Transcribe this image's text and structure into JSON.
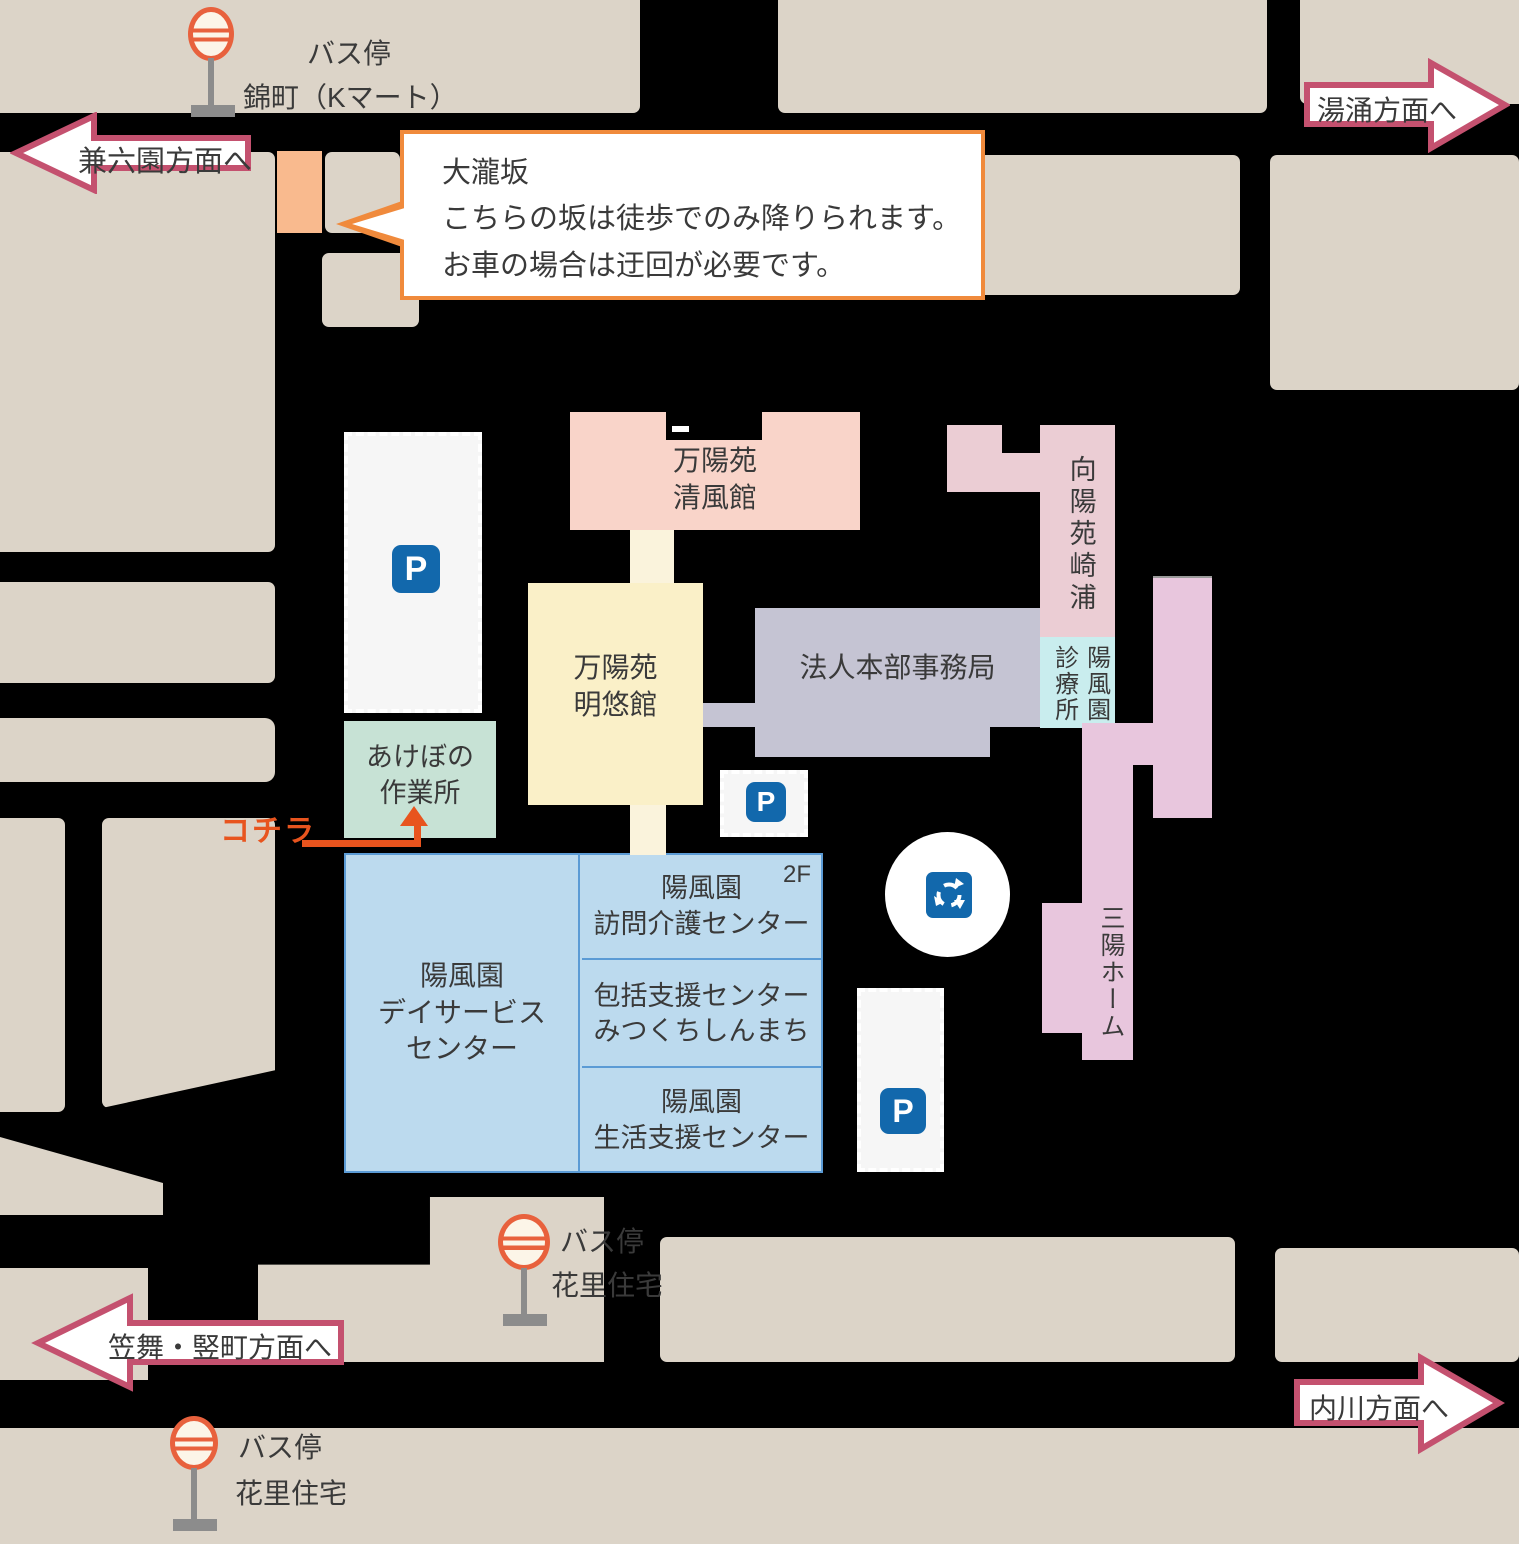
{
  "palette": {
    "road": "#000000",
    "city_block": "#dcd4c8",
    "arrow_border": "#c4516f",
    "callout_border": "#f08a3c",
    "here_accent": "#e8541e",
    "parking_blue": "#1268ac",
    "bus_stop_orange": "#e8613d",
    "slope_orange": "#f9ba8e",
    "text": "#3a3a3a",
    "blue_building_fill": "#bcdaee",
    "blue_building_border": "#5b9bd5"
  },
  "direction_arrows": {
    "kenrokuen": "兼六園方面へ",
    "yuwaku": "湯涌方面へ",
    "kasamai": "笠舞・竪町方面へ",
    "uchikawa": "内川方面へ"
  },
  "bus_stops": {
    "nishikimachi": {
      "line1": "バス停",
      "line2": "錦町（Kマート）"
    },
    "hanazato_mid": {
      "line1": "バス停",
      "line2": "花里住宅"
    },
    "hanazato_sw": {
      "line1": "バス停",
      "line2": "花里住宅"
    }
  },
  "callout": {
    "title": "大瀧坂",
    "line1": "こちらの坂は徒歩でのみ降りられます。",
    "line2": "お車の場合は迂回が必要です。"
  },
  "buildings": {
    "seifukan": {
      "line1": "万陽苑",
      "line2": "清風館",
      "color": "#f9d4c9"
    },
    "meiyukan": {
      "line1": "万陽苑",
      "line2": "明悠館",
      "color": "#faf0c8"
    },
    "honbu": {
      "label": "法人本部事務局",
      "color": "#c5c4d3"
    },
    "koyoen_sakiura": {
      "label": "向陽苑崎浦",
      "color": "#ebcdd4"
    },
    "clinic": {
      "col_right": "陽風園",
      "col_left": "診療所",
      "color": "#c9edee"
    },
    "sanyo_home": {
      "label": "三陽ホーム",
      "color": "#e8c6dd"
    },
    "akebono": {
      "line1": "あけぼの",
      "line2": "作業所",
      "color": "#c7e2d5"
    },
    "day_service": {
      "line1": "陽風園",
      "line2": "デイサービス",
      "line3": "センター"
    },
    "homon_kaigo": {
      "line1": "陽風園",
      "line2": "訪問介護センター",
      "floor": "2F"
    },
    "hokatsu": {
      "line1": "包括支援センター",
      "line2": "みつくちしんまち"
    },
    "seikatsu": {
      "line1": "陽風園",
      "line2": "生活支援センター"
    }
  },
  "here_label": "コチラ",
  "parking_label": "P"
}
